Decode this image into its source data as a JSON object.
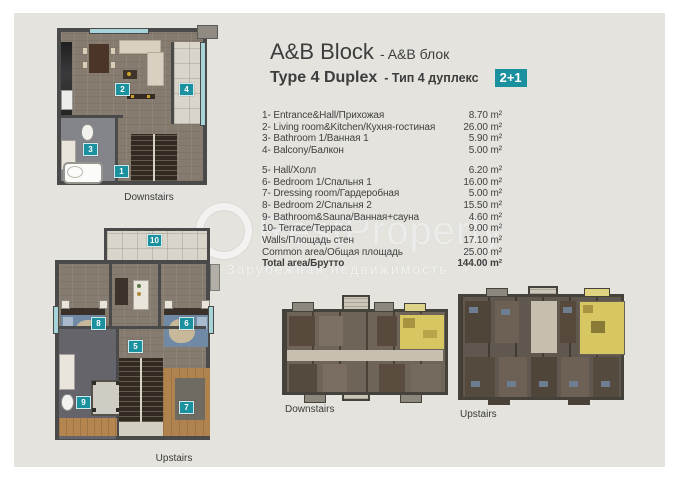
{
  "header": {
    "block_title": "A&B Block",
    "block_subtitle": "- A&B блок",
    "type_title": "Type 4 Duplex",
    "type_subtitle": "- Тип 4 дуплекс",
    "layout_badge": "2+1"
  },
  "room_list": {
    "rows": [
      {
        "label": "1- Entrance&Hall/Прихожая",
        "value": "8.70 m²"
      },
      {
        "label": "2- Living room&Kitchen/Кухня-гостиная",
        "value": "26.00 m²"
      },
      {
        "label": "3- Bathroom 1/Ванная 1",
        "value": "5.90 m²"
      },
      {
        "label": "4- Balcony/Балкон",
        "value": "5.00 m²"
      },
      {
        "label": "5- Hall/Холл",
        "value": "6.20 m²"
      },
      {
        "label": "6- Bedroom 1/Спальня 1",
        "value": "16.00 m²"
      },
      {
        "label": "7- Dressing room/Гардеробная",
        "value": "5.00 m²"
      },
      {
        "label": "8- Bedroom 2/Спальня 2",
        "value": "15.50 m²"
      },
      {
        "label": "9- Bathroom&Sauna/Ванная+сауна",
        "value": "4.60 m²"
      },
      {
        "label": "10- Terrace/Терраса",
        "value": "9.00 m²"
      },
      {
        "label": "Walls/Площадь стен",
        "value": "17.10 m²"
      },
      {
        "label": "Common area/Общая площадь",
        "value": "25.00 m²"
      },
      {
        "label": "Total area/Брутто",
        "value": "144.00 m²"
      }
    ]
  },
  "unit_plans": {
    "downstairs": {
      "label": "Downstairs",
      "rooms": [
        "1",
        "2",
        "3",
        "4"
      ]
    },
    "upstairs": {
      "label": "Upstairs",
      "rooms": [
        "5",
        "6",
        "7",
        "8",
        "9",
        "10"
      ]
    }
  },
  "building_plans": {
    "downstairs": {
      "label": "Downstairs"
    },
    "upstairs": {
      "label": "Upstairs"
    }
  },
  "watermark": {
    "brand": "RestProperty",
    "tagline": "Зарубежная недвижимость",
    "registered": "®"
  },
  "colors": {
    "accent_teal": "#1b909e",
    "unit_highlight_yellow": "#d7c763",
    "page_background": "#e4e3de"
  }
}
